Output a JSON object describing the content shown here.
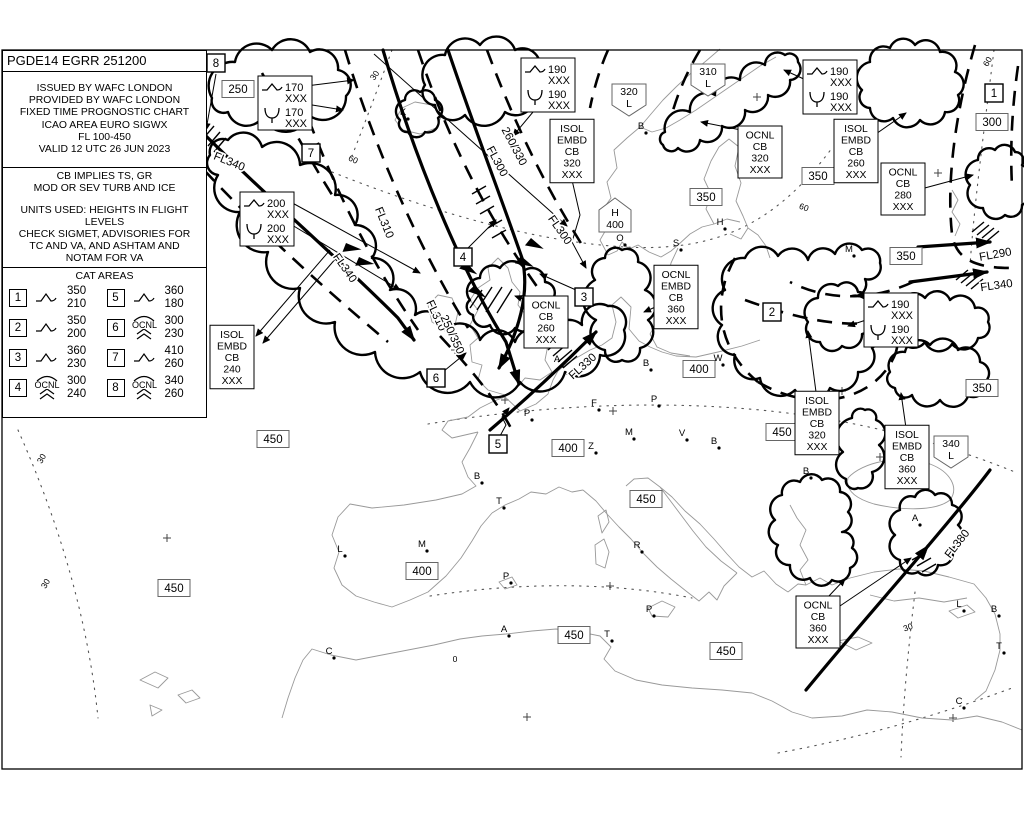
{
  "header": {
    "title": "PGDE14 EGRR 251200",
    "info_lines": [
      "ISSUED BY WAFC LONDON",
      "PROVIDED BY WAFC LONDON",
      "FIXED TIME PROGNOSTIC CHART",
      "ICAO AREA EURO SIGWX",
      "FL 100-450",
      "VALID 12 UTC 26 JUN 2023"
    ],
    "notes1": [
      "CB IMPLIES TS, GR",
      "MOD OR SEV TURB AND ICE"
    ],
    "notes2": [
      "UNITS USED: HEIGHTS IN FLIGHT LEVELS",
      "CHECK SIGMET, ADVISORIES FOR",
      "TC AND VA, AND ASHTAM AND",
      "NOTAM FOR VA"
    ]
  },
  "legend": {
    "title": "CAT AREAS",
    "entries": [
      {
        "n": "1",
        "sym": "turb",
        "ocnl": "",
        "top": "350",
        "bot": "210"
      },
      {
        "n": "5",
        "sym": "turb",
        "ocnl": "",
        "top": "360",
        "bot": "180"
      },
      {
        "n": "2",
        "sym": "turb",
        "ocnl": "",
        "top": "350",
        "bot": "200"
      },
      {
        "n": "6",
        "sym": "sev",
        "ocnl": "OCNL",
        "top": "300",
        "bot": "230"
      },
      {
        "n": "3",
        "sym": "turb",
        "ocnl": "",
        "top": "360",
        "bot": "230"
      },
      {
        "n": "7",
        "sym": "turb",
        "ocnl": "",
        "top": "410",
        "bot": "260"
      },
      {
        "n": "4",
        "sym": "sev",
        "ocnl": "OCNL",
        "top": "300",
        "bot": "240"
      },
      {
        "n": "8",
        "sym": "sev",
        "ocnl": "OCNL",
        "top": "340",
        "bot": "260"
      }
    ]
  },
  "map": {
    "cat_boxes": [
      {
        "n": "8",
        "x": 216,
        "y": 63
      },
      {
        "n": "7",
        "x": 311,
        "y": 153
      },
      {
        "n": "4",
        "x": 463,
        "y": 257
      },
      {
        "n": "3",
        "x": 584,
        "y": 297
      },
      {
        "n": "6",
        "x": 436,
        "y": 378
      },
      {
        "n": "5",
        "x": 498,
        "y": 444
      },
      {
        "n": "2",
        "x": 772,
        "y": 312
      },
      {
        "n": "1",
        "x": 994,
        "y": 93
      }
    ],
    "trop_rects": [
      {
        "v": "250",
        "x": 238,
        "y": 89
      },
      {
        "v": "450",
        "x": 273,
        "y": 439
      },
      {
        "v": "450",
        "x": 174,
        "y": 588
      },
      {
        "v": "400",
        "x": 422,
        "y": 571
      },
      {
        "v": "400",
        "x": 568,
        "y": 448
      },
      {
        "v": "400",
        "x": 699,
        "y": 369
      },
      {
        "v": "450",
        "x": 646,
        "y": 499
      },
      {
        "v": "450",
        "x": 574,
        "y": 635
      },
      {
        "v": "450",
        "x": 726,
        "y": 651
      },
      {
        "v": "350",
        "x": 706,
        "y": 197
      },
      {
        "v": "350",
        "x": 818,
        "y": 176
      },
      {
        "v": "350",
        "x": 906,
        "y": 256
      },
      {
        "v": "350",
        "x": 982,
        "y": 388
      },
      {
        "v": "450",
        "x": 782,
        "y": 432
      },
      {
        "v": "300",
        "x": 992,
        "y": 122
      }
    ],
    "trop_pents": [
      {
        "top": "320",
        "bot": "L",
        "dir": "down",
        "x": 629,
        "y": 96
      },
      {
        "top": "310",
        "bot": "L",
        "dir": "down",
        "x": 708,
        "y": 76
      },
      {
        "top": "H",
        "bot": "400",
        "dir": "up",
        "x": 615,
        "y": 217
      },
      {
        "top": "340",
        "bot": "L",
        "dir": "down",
        "x": 951,
        "y": 448
      }
    ],
    "wind_boxes": [
      {
        "x": 258,
        "y": 76,
        "rows": [
          [
            "turb",
            "170",
            "XXX"
          ],
          [
            "ice",
            "170",
            "XXX"
          ]
        ]
      },
      {
        "x": 240,
        "y": 192,
        "rows": [
          [
            "turb",
            "200",
            "XXX"
          ],
          [
            "ice",
            "200",
            "XXX"
          ]
        ]
      },
      {
        "x": 521,
        "y": 58,
        "rows": [
          [
            "turb",
            "190",
            "XXX"
          ],
          [
            "ice",
            "190",
            "XXX"
          ]
        ]
      },
      {
        "x": 803,
        "y": 60,
        "rows": [
          [
            "turb",
            "190",
            "XXX"
          ],
          [
            "ice",
            "190",
            "XXX"
          ]
        ]
      },
      {
        "x": 864,
        "y": 293,
        "rows": [
          [
            "turb",
            "190",
            "XXX"
          ],
          [
            "ice",
            "190",
            "XXX"
          ]
        ]
      }
    ],
    "cb_boxes": [
      {
        "x": 232,
        "y": 357,
        "lines": [
          "ISOL",
          "EMBD",
          "CB",
          "240",
          "XXX"
        ]
      },
      {
        "x": 572,
        "y": 151,
        "lines": [
          "ISOL",
          "EMBD",
          "CB",
          "320",
          "XXX"
        ]
      },
      {
        "x": 546,
        "y": 322,
        "lines": [
          "OCNL",
          "CB",
          "260",
          "XXX"
        ]
      },
      {
        "x": 676,
        "y": 297,
        "lines": [
          "OCNL",
          "EMBD",
          "CB",
          "360",
          "XXX"
        ]
      },
      {
        "x": 760,
        "y": 152,
        "lines": [
          "OCNL",
          "CB",
          "320",
          "XXX"
        ]
      },
      {
        "x": 856,
        "y": 151,
        "lines": [
          "ISOL",
          "EMBD",
          "CB",
          "260",
          "XXX"
        ]
      },
      {
        "x": 903,
        "y": 189,
        "lines": [
          "OCNL",
          "CB",
          "280",
          "XXX"
        ]
      },
      {
        "x": 817,
        "y": 423,
        "lines": [
          "ISOL",
          "EMBD",
          "CB",
          "320",
          "XXX"
        ]
      },
      {
        "x": 907,
        "y": 457,
        "lines": [
          "ISOL",
          "EMBD",
          "CB",
          "360",
          "XXX"
        ]
      },
      {
        "x": 818,
        "y": 622,
        "lines": [
          "OCNL",
          "CB",
          "360",
          "XXX"
        ]
      }
    ],
    "jet_labels": [
      {
        "t": "FL340",
        "x": 228,
        "y": 165,
        "r": 22
      },
      {
        "t": "FL340",
        "x": 342,
        "y": 270,
        "r": 55
      },
      {
        "t": "FL310",
        "x": 381,
        "y": 224,
        "r": 68
      },
      {
        "t": "FL310",
        "x": 433,
        "y": 317,
        "r": 65
      },
      {
        "t": "250/350",
        "x": 449,
        "y": 336,
        "r": 65
      },
      {
        "t": "FL300",
        "x": 494,
        "y": 163,
        "r": 62
      },
      {
        "t": "260/330",
        "x": 511,
        "y": 148,
        "r": 62
      },
      {
        "t": "FL300",
        "x": 557,
        "y": 232,
        "r": 55
      },
      {
        "t": "FL330",
        "x": 585,
        "y": 369,
        "r": -42
      },
      {
        "t": "FL380",
        "x": 960,
        "y": 546,
        "r": -52
      },
      {
        "t": "FL290",
        "x": 996,
        "y": 258,
        "r": -10
      },
      {
        "t": "FL340",
        "x": 997,
        "y": 289,
        "r": -8
      }
    ],
    "grat_labels": [
      {
        "t": "60",
        "x": 352,
        "y": 162,
        "r": 25
      },
      {
        "t": "60",
        "x": 803,
        "y": 210,
        "r": 20
      },
      {
        "t": "60",
        "x": 990,
        "y": 63,
        "r": -60
      },
      {
        "t": "30",
        "x": 377,
        "y": 77,
        "r": -55
      },
      {
        "t": "30",
        "x": 44,
        "y": 460,
        "r": -60
      },
      {
        "t": "30",
        "x": 48,
        "y": 585,
        "r": -60
      },
      {
        "t": "30",
        "x": 909,
        "y": 630,
        "r": -20
      },
      {
        "t": "0",
        "x": 455,
        "y": 662,
        "r": 0
      }
    ],
    "cities": [
      [
        "K",
        403,
        115
      ],
      [
        "B",
        641,
        129
      ],
      [
        "O",
        620,
        241
      ],
      [
        "S",
        676,
        246
      ],
      [
        "H",
        720,
        225
      ],
      [
        "M",
        849,
        252
      ],
      [
        "A",
        557,
        362
      ],
      [
        "B",
        646,
        366
      ],
      [
        "W",
        718,
        361
      ],
      [
        "P",
        654,
        402
      ],
      [
        "F",
        594,
        406
      ],
      [
        "P",
        527,
        416
      ],
      [
        "M",
        629,
        435
      ],
      [
        "V",
        682,
        436
      ],
      [
        "B",
        714,
        444
      ],
      [
        "Z",
        591,
        449
      ],
      [
        "B",
        477,
        479
      ],
      [
        "T",
        499,
        504
      ],
      [
        "M",
        422,
        547
      ],
      [
        "L",
        340,
        552
      ],
      [
        "R",
        637,
        548
      ],
      [
        "P",
        506,
        579
      ],
      [
        "P",
        649,
        612
      ],
      [
        "A",
        504,
        632
      ],
      [
        "T",
        607,
        637
      ],
      [
        "C",
        329,
        654
      ],
      [
        "B",
        806,
        474
      ],
      [
        "A",
        915,
        521
      ],
      [
        "L",
        959,
        607
      ],
      [
        "B",
        994,
        612
      ],
      [
        "T",
        999,
        649
      ],
      [
        "C",
        959,
        704
      ]
    ]
  }
}
